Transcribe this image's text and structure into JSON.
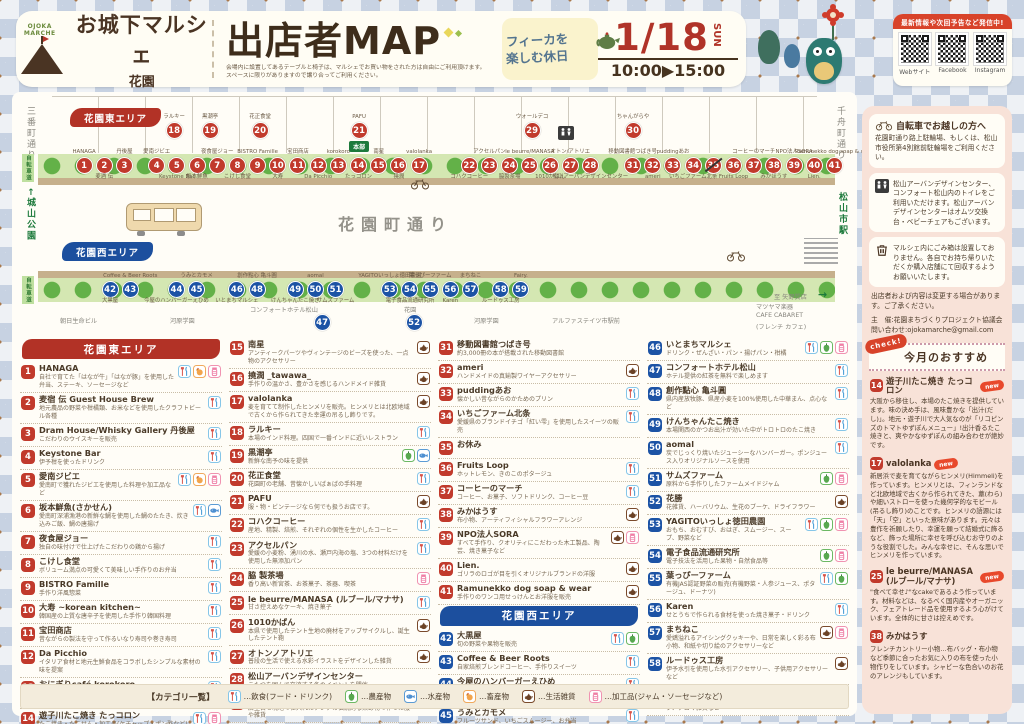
{
  "header": {
    "logo_mark": "OJOKA MARCHE",
    "logo_title": "お城下マルシェ",
    "logo_sub": "花園",
    "title": "出店者MAP",
    "note1": "会場内に設置してあるテーブルと椅子は、マルシェでお買い物をされた方は自由にご利用頂けます。",
    "note2": "スペースに限りがありますので譲り合ってご利用ください。",
    "fika_line1": "フィーカを",
    "fika_line2": "楽しむ休日",
    "date_md": "1/18",
    "date_dow": "SUN",
    "time": "10:00▶15:00",
    "sns_banner": "最新情報や次回予告など発信中!",
    "sns_items": [
      "Webサイト",
      "Facebook",
      "Instagram"
    ]
  },
  "map": {
    "east_area": "花園東エリア",
    "west_area": "花園西エリア",
    "street": "花園町通り",
    "road_left": "三番町通り",
    "road_right": "千舟町通り",
    "park_left": "←城山公園",
    "station_right": "松山市駅",
    "bikeway": "自転車道",
    "hq": "本部",
    "arrow": "→",
    "east_top": [
      {
        "n": 18,
        "t": "ラルキー",
        "x": 152
      },
      {
        "n": 19,
        "t": "黒潮亭",
        "x": 188
      },
      {
        "n": 20,
        "t": "花正食堂",
        "x": 238
      },
      {
        "n": 21,
        "t": "PAFU",
        "x": 337,
        "hq": true
      },
      {
        "n": 29,
        "t": "ウォールデコ",
        "x": 510
      },
      {
        "n": 30,
        "t": "ちゃんがらや",
        "x": 611
      }
    ],
    "east_row": [
      {
        "n": 1,
        "t": "HANAGA"
      },
      {
        "n": 2,
        "b": "麦酒 伝"
      },
      {
        "n": 3,
        "t": "丹後屋"
      },
      {
        "gap": 12
      },
      {
        "n": 4,
        "t": "愛南ジビエ"
      },
      {
        "n": 5,
        "b": "Keystone Bar"
      },
      {
        "n": 6,
        "b": "坂本鮮魚"
      },
      {
        "n": 7,
        "t": "夜食屋ジョー"
      },
      {
        "n": 8,
        "b": "こけし食堂"
      },
      {
        "n": 9,
        "t": "BISTRO Famille"
      },
      {
        "n": 10,
        "b": "大寿"
      },
      {
        "n": 11,
        "t": "宝田商店"
      },
      {
        "n": 12,
        "b": "Da Picchio"
      },
      {
        "n": 13,
        "t": "korokoro"
      },
      {
        "n": 14,
        "b": "たっコロン"
      },
      {
        "n": 15,
        "t": "南星"
      },
      {
        "n": 16,
        "b": "撓潤"
      },
      {
        "n": 17,
        "t": "valolanka"
      },
      {
        "gap": 30
      },
      {
        "n": 22,
        "b": "コハクコーヒー"
      },
      {
        "n": 23,
        "t": "アクセルパン"
      },
      {
        "n": 24,
        "b": "脇製茶場"
      },
      {
        "n": 25,
        "t": "le beurre/MANASA"
      },
      {
        "n": 26,
        "b": "1010かばん"
      },
      {
        "n": 27,
        "t": "オトン/アトリエ"
      },
      {
        "n": 28,
        "b": "松山アーバンデザインセンター"
      },
      {
        "gap": 22
      },
      {
        "n": 31,
        "t": "移動図書館つばき号"
      },
      {
        "n": 32,
        "b": "ameri"
      },
      {
        "n": 33,
        "t": "puddingあお"
      },
      {
        "n": 34,
        "b": "いちごファーム北条"
      },
      {
        "n": 35,
        "closed": true
      },
      {
        "n": 36,
        "b": "Fruits Loop"
      },
      {
        "n": 37,
        "t": "コーヒーのマーチ"
      },
      {
        "n": 38,
        "b": "みかほうす"
      },
      {
        "n": 39,
        "t": "NPO法人SORA"
      },
      {
        "n": 40,
        "b": "Lien."
      },
      {
        "n": 41,
        "t": "Ramunekko dog soap & wear"
      }
    ],
    "west_row": [
      {
        "n": 42,
        "b": "大黒屋"
      },
      {
        "n": 43,
        "t": "Coffee & Beer Roots"
      },
      {
        "gap": 26
      },
      {
        "n": 44,
        "b": "今屋のハンバーガーえひめ"
      },
      {
        "n": 45,
        "t": "うみとカモメ"
      },
      {
        "gap": 20
      },
      {
        "n": 46,
        "b": "いとまちマルシェ"
      },
      {
        "n": 48,
        "t": "創作點心 亀斗圓"
      },
      {
        "gap": 18
      },
      {
        "n": 49,
        "b": "けんちゃんたこ焼き"
      },
      {
        "n": 50,
        "t": "aomal"
      },
      {
        "n": 51,
        "b": "サムズファーム"
      },
      {
        "gap": 34
      },
      {
        "n": 53,
        "t": "YAGITOいっしょ徳田農園"
      },
      {
        "n": 54,
        "b": "電子食品流通研究所"
      },
      {
        "n": 55,
        "t": "葉っぴーファーム"
      },
      {
        "n": 56,
        "b": "Karen"
      },
      {
        "n": 57,
        "t": "まちねこ"
      },
      {
        "gap": 10
      },
      {
        "n": 58,
        "b": "ルードゥス工房"
      },
      {
        "n": 59,
        "t": "Fairy."
      }
    ],
    "below": [
      {
        "n": 47,
        "label": "コンフォートホテル松山",
        "x": 238,
        "bx": 300
      },
      {
        "n": 52,
        "label": "花園",
        "x": 392,
        "bx": 392
      }
    ],
    "buildings": [
      {
        "t": "朝日生命ビル",
        "x": 48,
        "y": 224
      },
      {
        "t": "河原学園",
        "x": 158,
        "y": 224
      },
      {
        "t": "河原学園",
        "x": 462,
        "y": 224
      },
      {
        "t": "アルファステイツ市駅前",
        "x": 540,
        "y": 224
      },
      {
        "t": "至 矢野質店",
        "x": 762,
        "y": 200
      },
      {
        "t": "マツヤマ楽器",
        "x": 744,
        "y": 210
      },
      {
        "t": "CAFE CABARET",
        "x": 744,
        "y": 220
      },
      {
        "t": "(フレンチ カフェ)",
        "x": 744,
        "y": 230
      }
    ]
  },
  "listing": {
    "east_header": "花園東エリア",
    "west_header": "花園西エリア",
    "columns": [
      [
        1,
        14
      ],
      [
        15,
        30
      ],
      [
        31,
        45
      ],
      [
        46,
        59
      ]
    ]
  },
  "vendors": [
    {
      "n": 1,
      "area": "east",
      "name": "HANAGA",
      "desc": "自社で育てた「はなが牛」「はなが豚」を使用した弁当、ステーキ、ソーセージなど",
      "cats": [
        "food",
        "livestock",
        "processed"
      ]
    },
    {
      "n": 2,
      "area": "east",
      "name": "麦宿 伝 Guest House Brew",
      "desc": "地元農品の野菜や柑橘類、お米などを使用したクラフトビール各種",
      "cats": [
        "food"
      ]
    },
    {
      "n": 3,
      "area": "east",
      "name": "Dram House/Whisky Gallery 丹後屋",
      "desc": "こだわりのウイスキーを販売",
      "cats": [
        "food"
      ]
    },
    {
      "n": 4,
      "area": "east",
      "name": "Keystone Bar",
      "desc": "伊予柑を使ったドリンク",
      "cats": [
        "food"
      ]
    },
    {
      "n": 5,
      "area": "east",
      "name": "愛南ジビエ",
      "desc": "愛南町で獲れたジビエを使用した料理や加工品など",
      "cats": [
        "food",
        "livestock",
        "processed"
      ]
    },
    {
      "n": 6,
      "area": "east",
      "name": "坂本鮮魚(さかせん)",
      "desc": "愛南町深浦漁港の新鮮な鯛を使用した鯛のたたき、炊き込みご飯、鯛の唐揚げ",
      "cats": [
        "food",
        "fish"
      ]
    },
    {
      "n": 7,
      "area": "east",
      "name": "夜食屋ジョー",
      "desc": "独自の味付けで仕上げたこだわりの鶏から揚げ",
      "cats": [
        "food"
      ]
    },
    {
      "n": 8,
      "area": "east",
      "name": "こけし食堂",
      "desc": "ボリューム満点の可愛くて美味しい手作りのお弁当",
      "cats": [
        "food"
      ]
    },
    {
      "n": 9,
      "area": "east",
      "name": "BISTRO Famille",
      "desc": "手作り洋風惣菜",
      "cats": [
        "food"
      ]
    },
    {
      "n": 10,
      "area": "east",
      "name": "大寿 ~korean kitchen~",
      "desc": "韓国産の上質な唐辛子を使用した手作り韓国料理",
      "cats": [
        "food"
      ]
    },
    {
      "n": 11,
      "area": "east",
      "name": "宝田商店",
      "desc": "昔ながらの製法を守って作るいなり寿司や巻き寿司",
      "cats": [
        "food"
      ]
    },
    {
      "n": 12,
      "area": "east",
      "name": "Da Picchio",
      "desc": "イタリア食材と地元生鮮食品をコラボしたシンプルな素材の味を提案",
      "cats": [
        "food"
      ]
    },
    {
      "n": 13,
      "area": "east",
      "name": "おにぎりcafé korokoro",
      "desc": "美味しいお米を使った手作りおにぎり。栄養バランスと彩りを考えた可愛いお弁当も。",
      "cats": [
        "food"
      ]
    },
    {
      "n": 14,
      "area": "east",
      "name": "遊子川たこ焼き たっコロン",
      "desc": "たこ焼き・たこせん・加工品(ケチャップ・ポン酢など)",
      "cats": [
        "food",
        "processed"
      ]
    },
    {
      "n": 15,
      "area": "east",
      "name": "南星",
      "desc": "アンティークパーツやヴィンテージのビーズを使った、一点物のアクセサリー",
      "cats": [
        "goods"
      ]
    },
    {
      "n": 16,
      "area": "east",
      "name": "撓潤 _tawawa_",
      "desc": "手作りの温かさ、豊かさを感じるハンドメイド雑貨",
      "cats": [
        "goods"
      ]
    },
    {
      "n": 17,
      "area": "east",
      "name": "valolanka",
      "desc": "麦を育てて制作したヒンメリを販売。ヒンメリとは北欧地域で古くから作られてきた幸運の吊るし飾りです。",
      "cats": [
        "goods"
      ]
    },
    {
      "n": 18,
      "area": "east",
      "name": "ラルキー",
      "desc": "本場のインド料理。四国で一番インドに近いレストラン",
      "cats": [
        "food"
      ]
    },
    {
      "n": 19,
      "area": "east",
      "name": "黒潮亭",
      "desc": "新鮮な南予の味を提供",
      "cats": [
        "agri",
        "fish"
      ]
    },
    {
      "n": 20,
      "area": "east",
      "name": "花正食堂",
      "desc": "花園町の老舗、昔懐かしいばぁばの手料理",
      "cats": [
        "food"
      ]
    },
    {
      "n": 21,
      "area": "east",
      "name": "PAFU",
      "desc": "服・物・ビンテージなら何でも扱うお店です。",
      "cats": [
        "goods"
      ]
    },
    {
      "n": 22,
      "area": "east",
      "name": "コハクコーヒー",
      "desc": "産地、精製、焙煎、それぞれの個性を生かしたコーヒー",
      "cats": [
        "food"
      ]
    },
    {
      "n": 23,
      "area": "east",
      "name": "アクセルパン",
      "desc": "愛媛の小麦粉、湧川の水、瀬戸内海の塩、3つの材料だけを使用した無添加パン",
      "cats": [
        "food"
      ]
    },
    {
      "n": 24,
      "area": "east",
      "name": "脇 製茶場",
      "desc": "香り高い新宮茶、お茶菓子、茶器、喫茶",
      "cats": [
        "processed"
      ]
    },
    {
      "n": 25,
      "area": "east",
      "name": "le beurre/MANASA (ルブール/マナサ)",
      "desc": "甘さ控えめなケーキ、焼き菓子",
      "cats": [
        "food"
      ]
    },
    {
      "n": 26,
      "area": "east",
      "name": "1010かばん",
      "desc": "本県で使用したテント生地の廃材をアップサイクルし、誕生したテント鞄",
      "cats": [
        "goods"
      ]
    },
    {
      "n": 27,
      "area": "east",
      "name": "オトンノアトリエ",
      "desc": "普段の生活で使える水彩イラストをデザインした雑貨",
      "cats": [
        "goods"
      ]
    },
    {
      "n": 28,
      "area": "east",
      "name": "松山アーバンデザインセンター",
      "desc": "こたつを囲んで交流する冬のイベントを開催",
      "cats": []
    },
    {
      "n": 29,
      "area": "east",
      "name": "ウォールデコ",
      "desc": "店主自ら現地で仕入れたアジアの伝統的な染め物で作った服や雑貨",
      "cats": [
        "goods"
      ]
    },
    {
      "n": 30,
      "area": "east",
      "name": "ちゃんがらや",
      "desc": "本場大阪仕込みの美味しいたこ焼き",
      "cats": [
        "food"
      ]
    },
    {
      "n": 31,
      "area": "east",
      "name": "移動図書館つばき号",
      "desc": "約3,000冊の本が搭載された移動図書館",
      "cats": []
    },
    {
      "n": 32,
      "area": "east",
      "name": "ameri",
      "desc": "ハンドメイドの真鍮製ワイヤーアクセサリー",
      "cats": [
        "goods"
      ]
    },
    {
      "n": 33,
      "area": "east",
      "name": "puddingあお",
      "desc": "懐かしい昔ながらのかためのプリン",
      "cats": [
        "food"
      ]
    },
    {
      "n": 34,
      "area": "east",
      "name": "いちごファーム北条",
      "desc": "愛媛県のブランドイチゴ「紅い雫」を使用したスイーツの販売",
      "cats": [
        "food"
      ]
    },
    {
      "n": 35,
      "area": "east",
      "name": "お休み",
      "desc": "",
      "cats": []
    },
    {
      "n": 36,
      "area": "east",
      "name": "Fruits Loop",
      "desc": "ホットレモン、きのこのポタージュ",
      "cats": [
        "food"
      ]
    },
    {
      "n": 37,
      "area": "east",
      "name": "コーヒーのマーチ",
      "desc": "コーヒー、お菓子、ソフトドリンク、コーヒー豆",
      "cats": [
        "food"
      ]
    },
    {
      "n": 38,
      "area": "east",
      "name": "みかはうす",
      "desc": "布小物、アーティフィシャルフラワーアレンジ",
      "cats": [
        "goods"
      ]
    },
    {
      "n": 39,
      "area": "east",
      "name": "NPO法人SORA",
      "desc": "すべて手作り、クオリティにこだわった木工製品、陶芸、焼き菓子など",
      "cats": [
        "goods",
        "processed"
      ]
    },
    {
      "n": 40,
      "area": "east",
      "name": "Lien.",
      "desc": "ゴリラのロゴが目を引くオリジナルブランドの洋服",
      "cats": [
        "goods"
      ]
    },
    {
      "n": 41,
      "area": "east",
      "name": "Ramunekko dog soap & wear",
      "desc": "手作りのワンコ用せっけんとお洋服を販売",
      "cats": [
        "goods"
      ]
    },
    {
      "n": 42,
      "area": "west",
      "name": "大黒屋",
      "desc": "旬の野菜や果物を販売",
      "cats": [
        "food",
        "agri"
      ]
    },
    {
      "n": 43,
      "area": "west",
      "name": "Coffee & Beer Roots",
      "desc": "自家焙煎ブレンドコーヒー、手作りスイーツ",
      "cats": [
        "food"
      ]
    },
    {
      "n": 44,
      "area": "west",
      "name": "今屋のハンバーガーえひめ",
      "desc": "自慢の手作りハンバーグ、秘伝のソース、新鮮野菜、ホットドッグスタイルのハンバーガー",
      "cats": [
        "food"
      ]
    },
    {
      "n": 45,
      "area": "west",
      "name": "うみとカモメ",
      "desc": "フルーツサンド、いちごスムージー、お弁当",
      "cats": [
        "food"
      ]
    },
    {
      "n": 46,
      "area": "west",
      "name": "いとまちマルシェ",
      "desc": "ドリンク・ぜんざい・パン・揚げパン・柑橘",
      "cats": [
        "food",
        "agri",
        "processed"
      ]
    },
    {
      "n": 47,
      "area": "west",
      "name": "コンフォートホテル松山",
      "desc": "ホテル提供の紅茶を無料で楽しめます",
      "cats": [
        "food"
      ]
    },
    {
      "n": 48,
      "area": "west",
      "name": "創作點心 亀斗圓",
      "desc": "県内産放牧豚、県産小麦を100%使用した中華まん、点心など",
      "cats": [
        "food"
      ]
    },
    {
      "n": 49,
      "area": "west",
      "name": "けんちゃんたこ焼き",
      "desc": "本場関西のかつお出汁が効いた中がトロトロのたこ焼き",
      "cats": [
        "food"
      ]
    },
    {
      "n": 50,
      "area": "west",
      "name": "aomal",
      "desc": "炭でじっくり焼いたジューシーなハンバーガー。ポンジュース入りオリジナルソースを使用",
      "cats": [
        "food"
      ]
    },
    {
      "n": 51,
      "area": "west",
      "name": "サムズファーム",
      "desc": "原料から手作りしたファームメイドジャム",
      "cats": [
        "agri",
        "processed"
      ]
    },
    {
      "n": 52,
      "area": "west",
      "name": "花勝",
      "desc": "花雑貨、ハーバリウム、生花のブーケ、ドライフラワー",
      "cats": [
        "goods"
      ]
    },
    {
      "n": 53,
      "area": "west",
      "name": "YAGITOいっしょ徳田農園",
      "desc": "おもち、おむすび、おはぎ、スムージー、スープ、野菜など",
      "cats": [
        "food",
        "agri",
        "processed"
      ]
    },
    {
      "n": 54,
      "area": "west",
      "name": "電子食品流通研究所",
      "desc": "電子技法を活用した果物・自然食品等",
      "cats": [
        "agri",
        "processed"
      ]
    },
    {
      "n": 55,
      "area": "west",
      "name": "葉っぴーファーム",
      "desc": "有機JAS認証野菜の販売(有機野菜・人参ジュース、ポタージュ、ドーナツ)",
      "cats": [
        "food",
        "agri"
      ]
    },
    {
      "n": 56,
      "area": "west",
      "name": "Karen",
      "desc": "せとうちで作られる食材を使った焼き菓子・ドリンク",
      "cats": [
        "food"
      ]
    },
    {
      "n": 57,
      "area": "west",
      "name": "まちねこ",
      "desc": "愛嬌溢れるアイシングクッキーや、日常を楽しく彩る布小物、和紙や切り絵のアクセサリーなど",
      "cats": [
        "goods",
        "processed"
      ]
    },
    {
      "n": 58,
      "area": "west",
      "name": "ルードゥス工房",
      "desc": "伊予水引を使用した水引アクセサリー、子供用アクセサリーなど",
      "cats": [
        "goods"
      ]
    },
    {
      "n": 59,
      "area": "west",
      "name": "Fairy.",
      "desc": "ヨーロッパの輸入リバティを使った布雑貨、ワークショップ、アロマ雑貨など",
      "cats": [
        "goods"
      ]
    }
  ],
  "legend": {
    "title": "【カテゴリ一覧】",
    "items": [
      {
        "key": "food",
        "label": "…飲食(フード・ドリンク)"
      },
      {
        "key": "agri",
        "label": "…農産物"
      },
      {
        "key": "fish",
        "label": "…水産物"
      },
      {
        "key": "livestock",
        "label": "…畜産物"
      },
      {
        "key": "goods",
        "label": "…生活雑貨"
      },
      {
        "key": "processed",
        "label": "…加工品(ジャム・ソーセージなど)"
      }
    ]
  },
  "sidebar": {
    "bike_title": "自転車でお越しの方へ",
    "bike_text": "花園町通り路上駐輪場、もしくは、松山市役所第4別館前駐輪場をご利用ください。",
    "toilet_text": "松山アーバンデザインセンター、コンフォート松山内のトイレをご利用いただけます。松山アーバンデザインセンターはオムツ交換台・ベビーチェアもございます。",
    "trash_text": "マルシェ内にごみ箱は設置しておりません。各自でお持ち帰りいただくか購入店舗にて回収するようお願いいたします。",
    "notice": "出店者および内容は変更する場合があります。ご了承ください。",
    "organizer": "主　催:花園まちづくりプロジェクト協議会",
    "contact": "問い合わせ:ojokamarche@gmail.com",
    "check": "check!",
    "reco_title": "今月のおすすめ",
    "new_label": "new",
    "features": [
      {
        "n": "14",
        "name": "遊子川たこ焼き たっコロン",
        "isNew": true,
        "text": "大阪から移住し、本場のたこ焼きを提供しています。味の決め手は、風味豊かな「出汁(だし)」。地元・遊子川で大人気なのが「リコピンズのトマトゆずぽんメニュー」!出汁香るたこ焼きと、爽やかなゆずぽんの組み合わせが絶妙です。"
      },
      {
        "n": "17",
        "name": "valolanka",
        "isNew": true,
        "text": "新居浜で麦を育てながらヒンメリ(Himmeli)を作っています。ヒンメリとは、フィンランドなど北欧地域で古くから作られてきた、藁(わら)や細いストローを使った幾何学的なモビール(吊るし飾り)のことです。ヒンメリの語源には「天」「空」といった意味があります。元々は豊作を祈願したり、幸運を願って結婚式に飾るなど、飾った場所に幸せを呼び込むお守りのような役割でした。みんな幸せに、そんな思いでヒンメリを作っています。"
      },
      {
        "n": "25",
        "name": "le beurre/MANASA (ルブール/マナサ)",
        "isNew": true,
        "text": "\"食べて幸せ♪\"なcakeであるよう作っています。材料などは、なるべく国内産やオーガニック、フェアトレード品を使用するよう心がけています。全体的に甘さは控えめです。"
      },
      {
        "n": "38",
        "name": "みかはうす",
        "isNew": false,
        "text": "フレンチカントリー小物…布バッグ・布小物など季節に合ったお気に入りの布を使った小物作りをしています。シャビーな色合いのお花のアレンジもしています。"
      }
    ]
  }
}
